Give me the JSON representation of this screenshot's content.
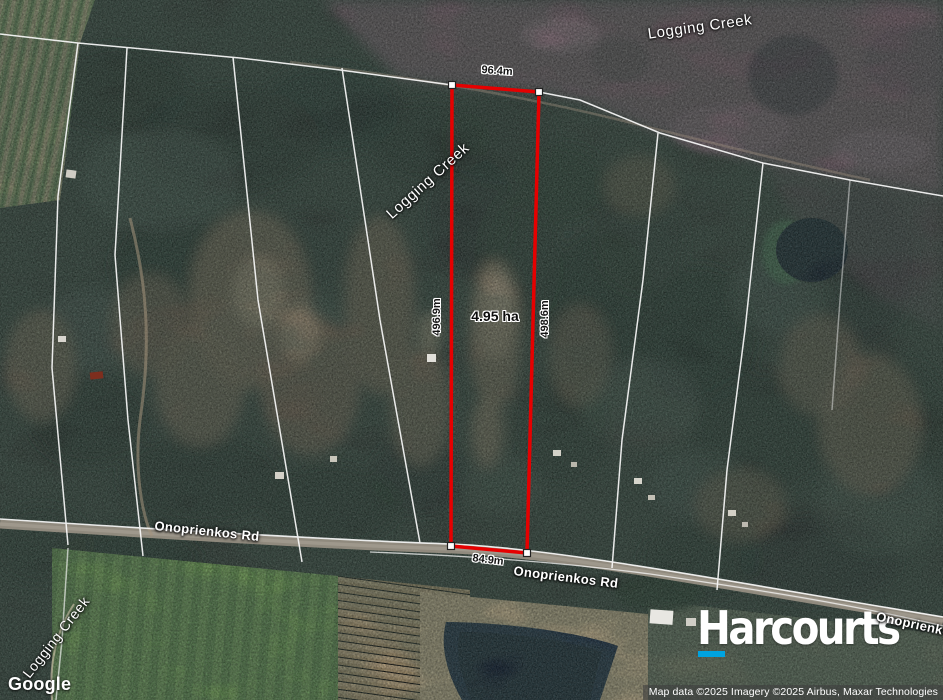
{
  "map": {
    "provider": "Google",
    "attribution": "Map data ©2025 Imagery ©2025 Airbus, Maxar Technologies",
    "creek_labels": [
      {
        "text": "Logging Creek"
      },
      {
        "text": "Logging Creek"
      },
      {
        "text": "Logging Creek"
      }
    ],
    "road_labels": [
      {
        "text": "Onoprienkos Rd"
      },
      {
        "text": "Onoprienkos Rd"
      },
      {
        "text": "Onoprienkos Rd"
      }
    ],
    "parcel": {
      "area": "4.95 ha",
      "side_top": "96.4m",
      "side_left": "496.9m",
      "side_right": "498.6m",
      "side_bottom": "84.9m",
      "outline_color": "#e60000"
    }
  },
  "branding": {
    "agency": "Harcourts",
    "accent_color": "#00a3e0"
  }
}
